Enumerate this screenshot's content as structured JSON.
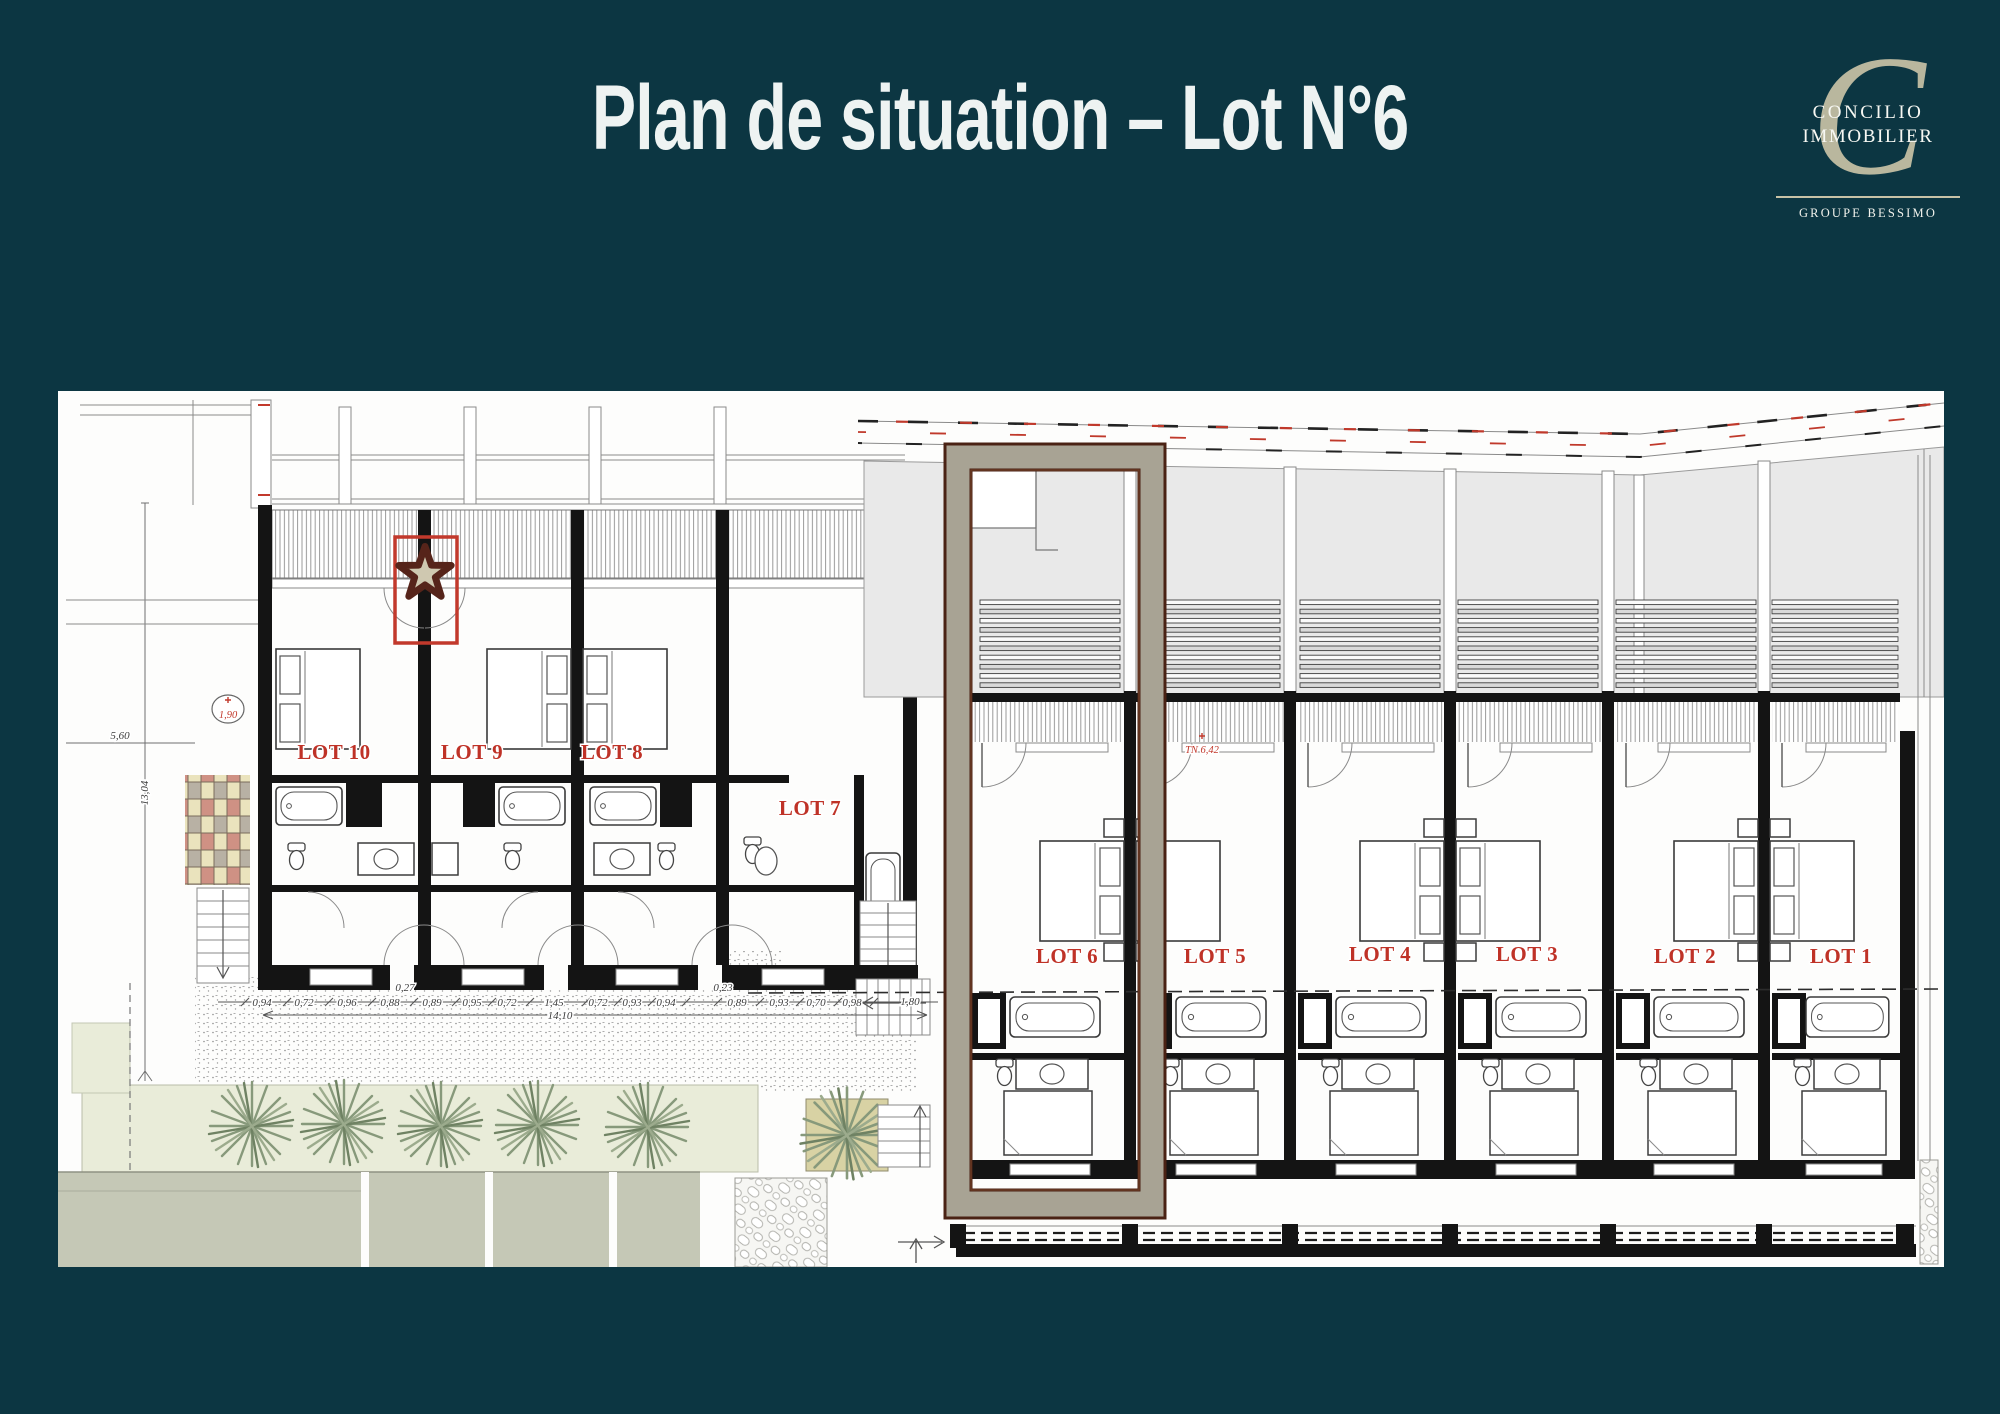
{
  "slide": {
    "title": "Plan de situation – Lot N°6"
  },
  "logo": {
    "monogram": "C",
    "name_line1": "CONCILIO",
    "name_line2": "IMMOBILIER",
    "group": "GROUPE BESSIMO"
  },
  "colors": {
    "background": "#0c3642",
    "accent_red": "#c0392b",
    "highlight_frame_band": "#a8a394",
    "highlight_frame_edge": "#4a2214",
    "logo_beige": "#c8c2a6",
    "vegetation_green": "#8a9a7b",
    "lawn_green": "#e9ecd9",
    "paving_sage": "#c5c8b6"
  },
  "plan": {
    "lot_labels": [
      "LOT 10",
      "LOT 9",
      "LOT 8",
      "LOT 7",
      "LOT 6",
      "LOT 5",
      "LOT 4",
      "LOT 3",
      "LOT 2",
      "LOT 1"
    ],
    "highlighted_lot": "LOT 6",
    "dim_chain": [
      "0,94",
      "0,72",
      "0,96",
      "0,88",
      "0,89",
      "0,95",
      "0,72",
      "1,45",
      "0,72",
      "0,93",
      "0,94",
      "0,89",
      "0,93",
      "0,70",
      "0,98",
      "1,80"
    ],
    "dim_above": [
      "0,27",
      "0,23"
    ],
    "dim_total": "14,10",
    "dim_width": "5,60",
    "dim_height": "13,04",
    "level_marker": "1,90",
    "terrain_marker": "TN 6,42"
  }
}
